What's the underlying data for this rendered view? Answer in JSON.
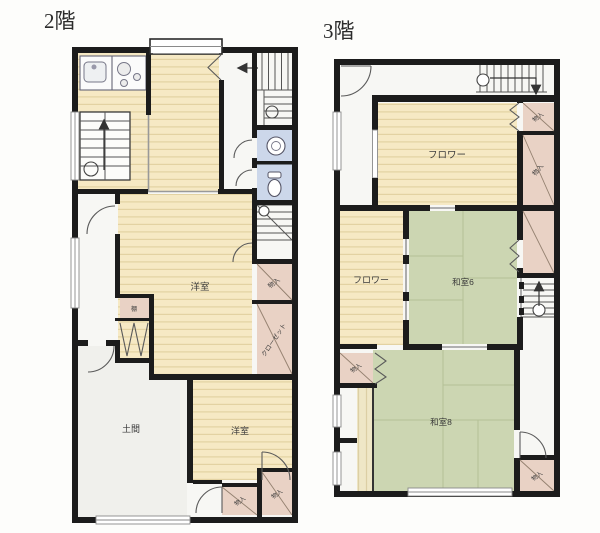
{
  "titles": {
    "floor2": "2階",
    "floor3": "3階"
  },
  "floor2": {
    "rooms": {
      "main_room": "洋室",
      "south_room": "洋室",
      "doma": "土間",
      "shelf": "棚",
      "storage_right": "物入",
      "closet_right": "クローゼット",
      "storage_south_left": "物入",
      "storage_south_right": "物入"
    }
  },
  "floor3": {
    "rooms": {
      "floor_north": "フロワー",
      "floor_west": "フロワー",
      "washitsu6": "和室6",
      "washitsu8": "和室8",
      "storage_ne_upper": "物入",
      "storage_ne_lower": "物入",
      "storage_west": "物入",
      "storage_se": "物入"
    }
  },
  "colors": {
    "wall": "#1c1c1c",
    "wood_floor": "#f6e9c4",
    "veranda_floor": "#efe7c6",
    "tatami": "#ccd6b2",
    "storage": "#e9d2c5",
    "wet_room": "#ccd7ea",
    "doma_floor": "#f0f0ec"
  }
}
